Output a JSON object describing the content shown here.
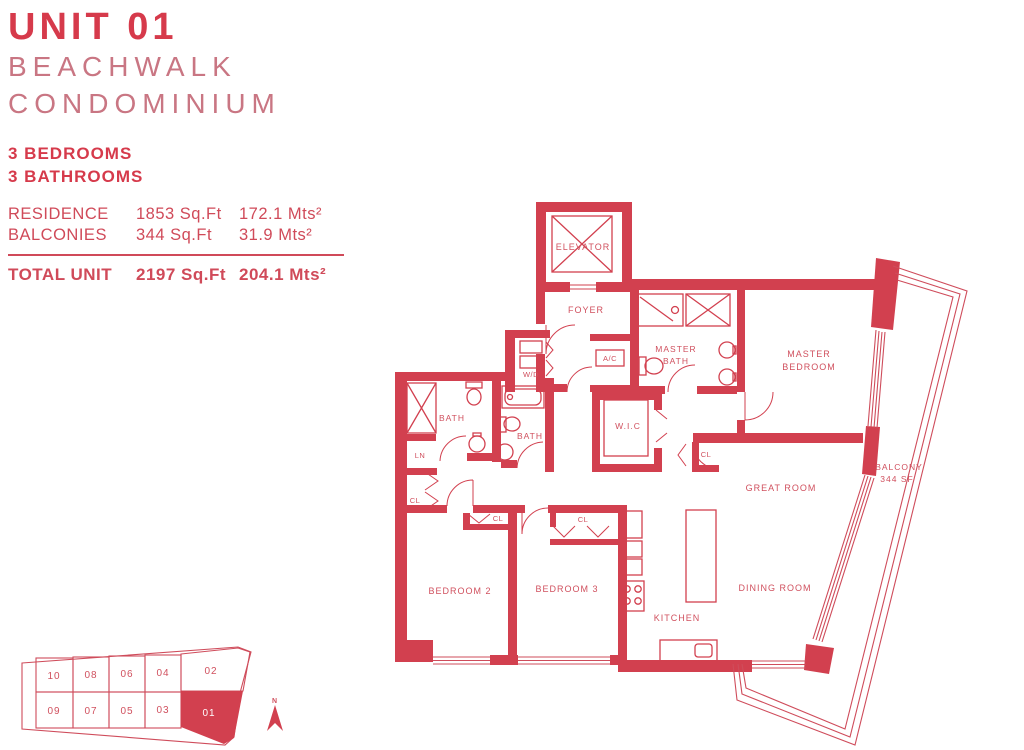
{
  "header": {
    "unit_title": "UNIT 01",
    "building_name_line1": "BEACHWALK",
    "building_name_line2": "CONDOMINIUM",
    "bedrooms": "3 BEDROOMS",
    "bathrooms": "3 BATHROOMS"
  },
  "area_table": {
    "rows": [
      {
        "label": "RESIDENCE",
        "sqft": "1853 Sq.Ft",
        "mts": "172.1 Mts²"
      },
      {
        "label": "BALCONIES",
        "sqft": "344 Sq.Ft",
        "mts": "31.9 Mts²"
      }
    ],
    "total_row": {
      "label": "TOTAL UNIT",
      "sqft": "2197 Sq.Ft",
      "mts": "204.1 Mts²"
    }
  },
  "floorplan": {
    "labels": {
      "elevator": "ELEVATOR",
      "foyer": "FOYER",
      "wd": "W/D",
      "ac": "A/C",
      "master_bath_line1": "MASTER",
      "master_bath_line2": "BATH",
      "master_bedroom_line1": "MASTER",
      "master_bedroom_line2": "BEDROOM",
      "bath": "BATH",
      "ln": "LN",
      "wic": "W.I.C",
      "cl": "CL",
      "great_room": "GREAT ROOM",
      "balcony_line1": "BALCONY",
      "balcony_line2": "344 SF",
      "bedroom2": "BEDROOM 2",
      "bedroom3": "BEDROOM 3",
      "kitchen": "KITCHEN",
      "dining_room": "DINING ROOM"
    }
  },
  "keyplan": {
    "top_row": [
      "10",
      "08",
      "06",
      "04",
      "02"
    ],
    "bottom_row": [
      "09",
      "07",
      "05",
      "03",
      "01"
    ],
    "highlighted_unit": "01",
    "north_label": "N"
  },
  "colors": {
    "wall_red": "#d2404f",
    "text_red": "#d63a4b",
    "light_red": "#c97683",
    "highlight_fill": "#d2404f",
    "white": "#ffffff"
  }
}
